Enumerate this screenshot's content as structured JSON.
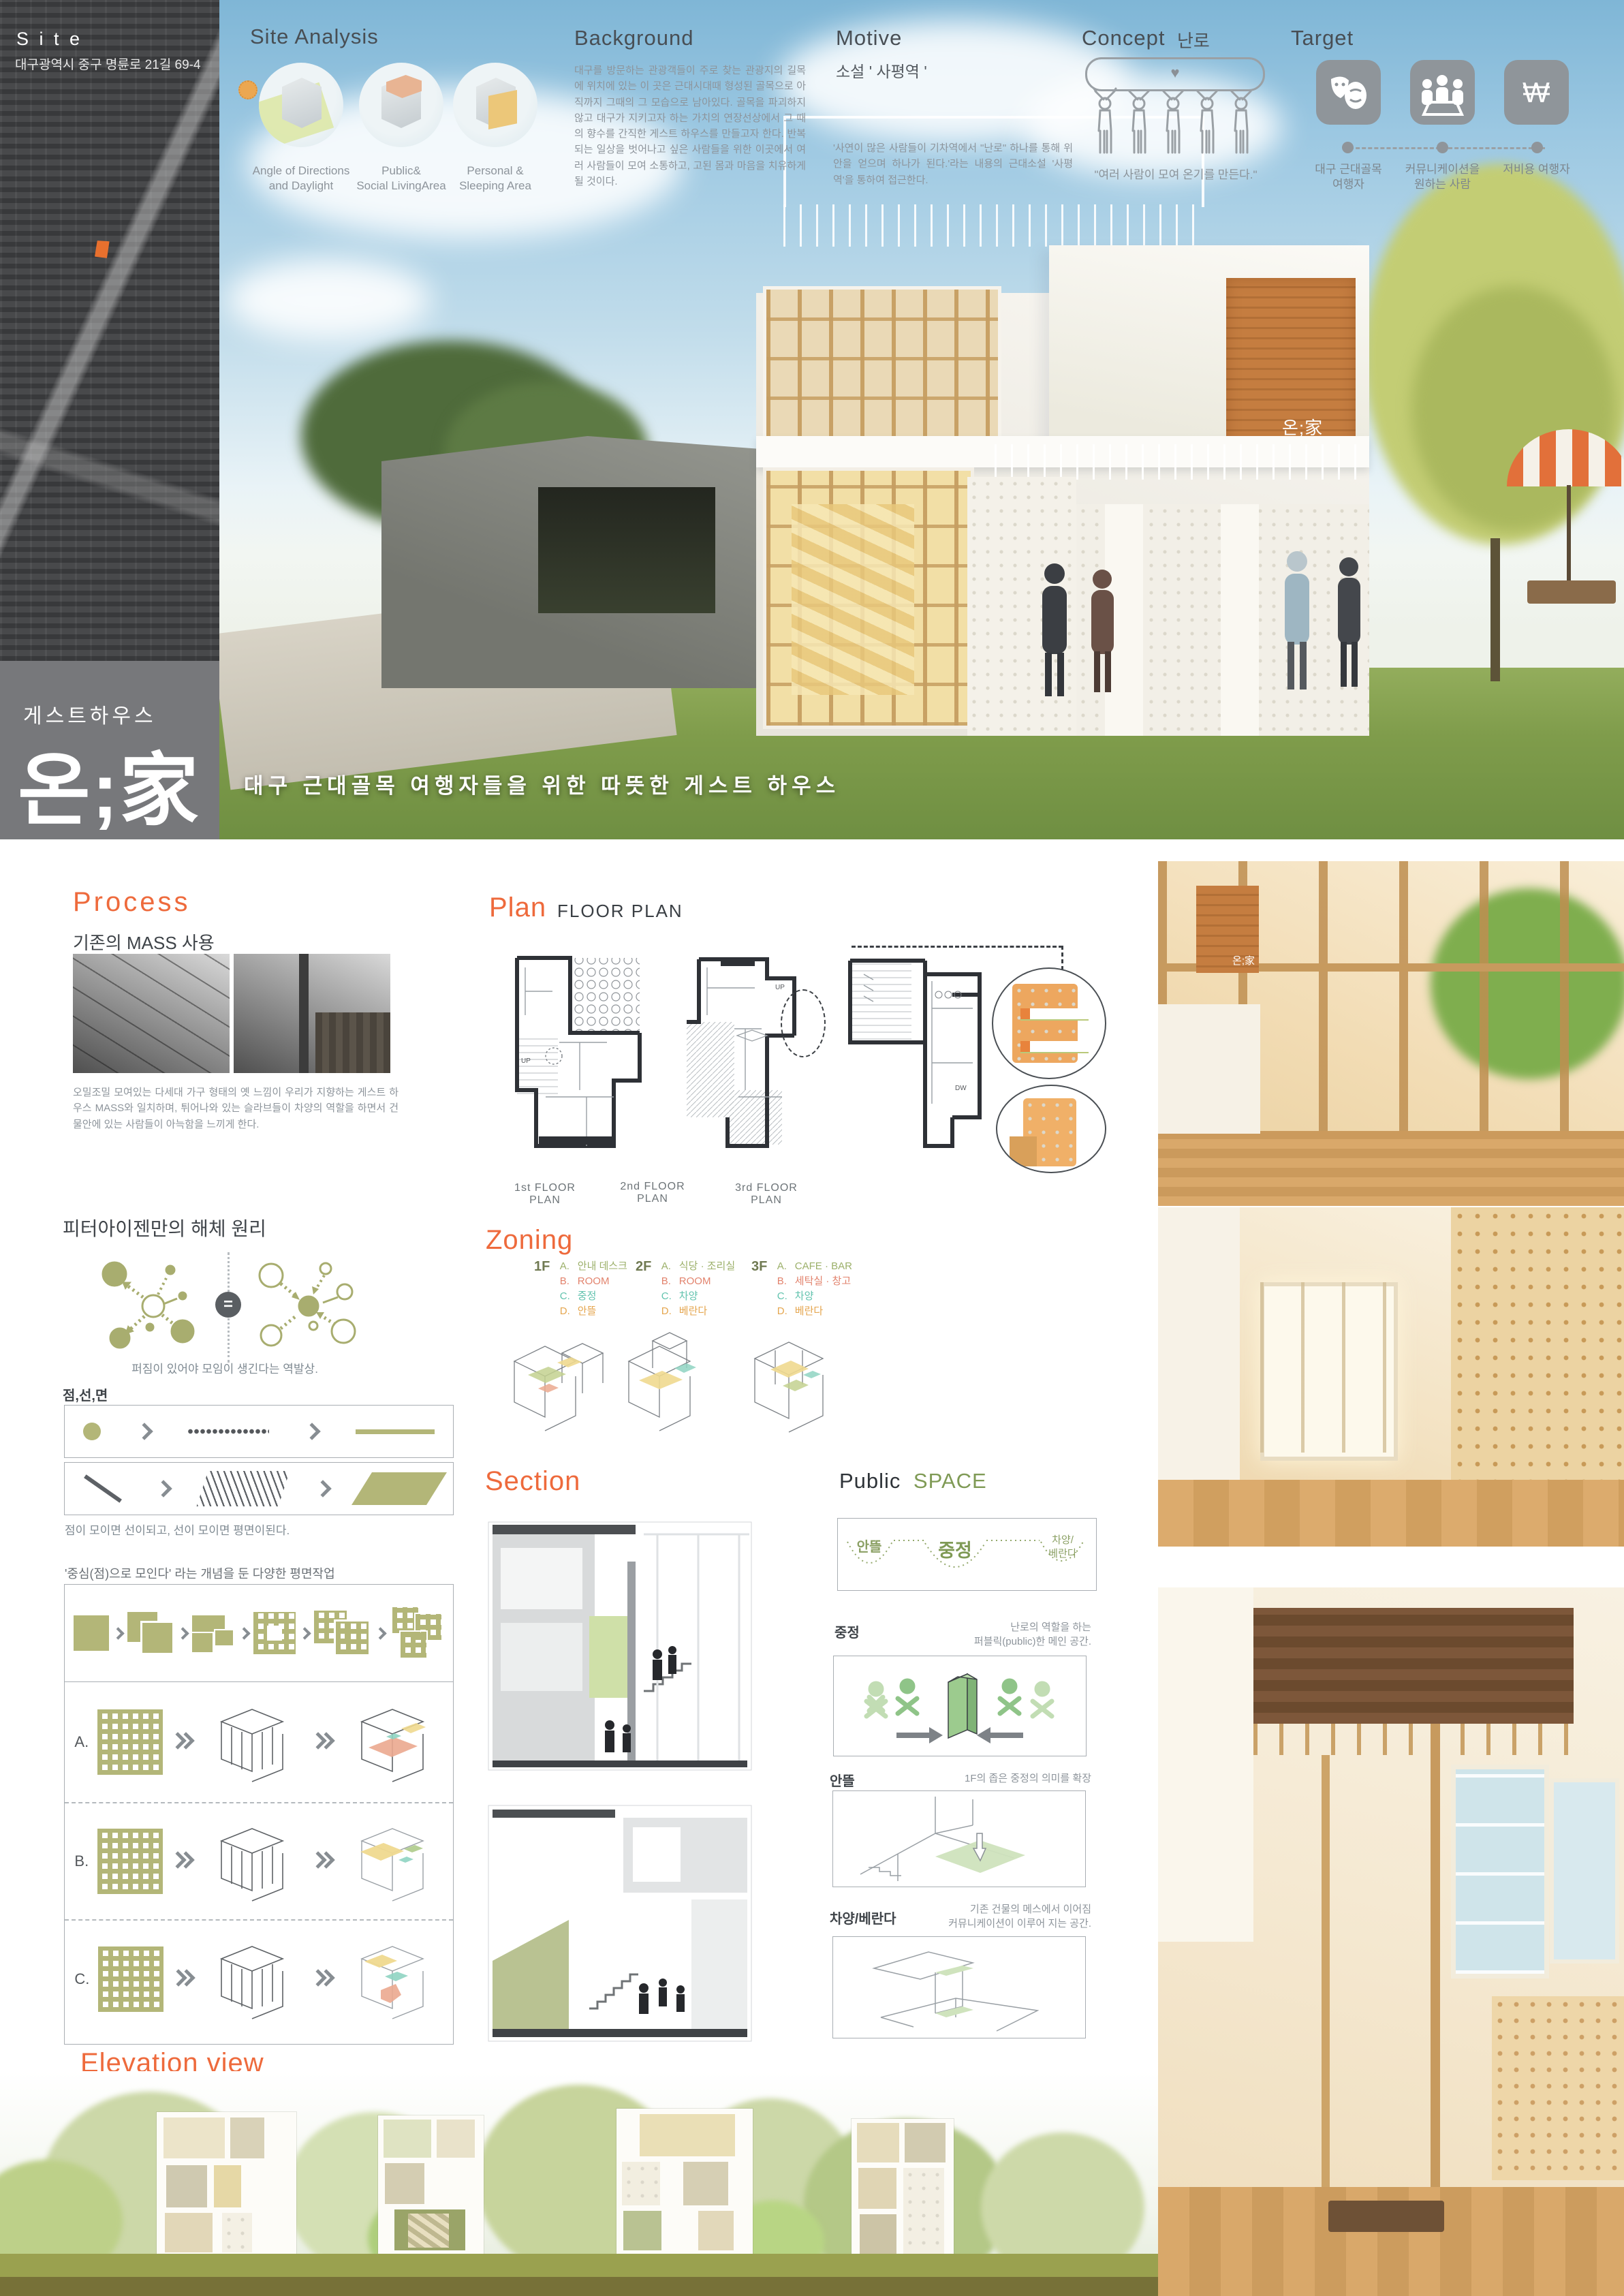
{
  "colors": {
    "accent_orange": "#ee6a3c",
    "olive": "#b3b678",
    "sky_blue": "#9cc8e2",
    "sidebar_gray": "#77787b",
    "zone_a_green": "#9cb06a",
    "zone_b_salmon": "#e2836d",
    "zone_c_teal": "#62c3ae",
    "zone_d_orange": "#e5a64f"
  },
  "icons": {
    "heart": "♥",
    "won": "W"
  },
  "sidebar": {
    "site_title": "S i t e",
    "site_address": "대구광역시 중구 명륜로 21길 69-4",
    "logo_category": "게스트하우스",
    "logo_name": "온;家"
  },
  "hero": {
    "tagline": "대구 근대골목 여행자들을 위한 따뜻한 게스트 하우스",
    "building_sign": "온;家"
  },
  "site_analysis": {
    "title": "Site Analysis",
    "items": [
      {
        "label_line1": "Angle of Directions",
        "label_line2": "and Daylight"
      },
      {
        "label_line1": "Public&",
        "label_line2": "Social LivingArea"
      },
      {
        "label_line1": "Personal &",
        "label_line2": "Sleeping Area"
      }
    ]
  },
  "background": {
    "title": "Background",
    "body": "대구를 방문하는 관광객들이 주로 찾는 관광지의 길목에 위치에 있는 이 곳은 근대시대때 형성된 골목으로 아직까지 그때의 그 모습으로 남아있다. 골목을 파괴하지 않고 대구가 지키고자 하는 가치의 연장선상에서 그 때의 향수를 간직한 게스트 하우스를 만들고자 한다. 반복되는 일상을 벗어나고 싶은 사람들을 위한 이곳에서 여러 사람들이 모여 소통하고, 고된 몸과 마음을 치유하게 될 것이다."
  },
  "motive": {
    "title": "Motive",
    "subtitle": "소설 ' 사평역 '",
    "body": "'사연이 많은 사람들이 기차역에서 \"난로\" 하나를 통해 위안을 얻으며 하나가 된다.'라는 내용의 근대소설 '사평역'을 통하여 접근한다."
  },
  "concept": {
    "title": "Concept",
    "keyword": "난로",
    "caption": "\"여러 사람이 모여 온기를 만든다.\""
  },
  "target": {
    "title": "Target",
    "items": [
      {
        "icon": "theater-masks-icon",
        "label_line1": "대구 근대골목",
        "label_line2": "여행자"
      },
      {
        "icon": "meeting-people-icon",
        "label_line1": "커뮤니케이션을",
        "label_line2": "원하는 사람"
      },
      {
        "icon": "won-currency-icon",
        "label_line1": "저비용 여행자",
        "label_line2": ""
      }
    ]
  },
  "process": {
    "title": "Process",
    "subtitle": "기존의 MASS 사용",
    "body": "오밀조밀 모여있는 다세대 가구 형태의 옛 느낌이 우리가 지향하는 게스트 하우스 MASS와 일치하며, 튀어나와 있는 슬라브들이 차양의 역할을 하면서 건물안에 있는 사람들이 아늑함을 느끼게 한다."
  },
  "eisenman": {
    "title": "피터아이젠만의 해체 원리",
    "equals_sign": "=",
    "caption": "퍼짐이 있어야 모임이 생긴다는 역발상."
  },
  "point_line_plane": {
    "title": "점,선,면",
    "caption": "점이 모이면 선이되고, 선이 모이면 평면이된다.",
    "concept_caption": "'중심(점)으로 모인다' 라는 개념을 둔 다양한 평면작업",
    "row_labels": [
      "A.",
      "B.",
      "C."
    ]
  },
  "plan": {
    "title": "Plan",
    "subtitle": "FLOOR PLAN",
    "floor_labels": [
      "1st FLOOR PLAN",
      "2nd FLOOR PLAN",
      "3rd FLOOR PLAN"
    ],
    "annotations": [
      "UP",
      "DW"
    ]
  },
  "zoning": {
    "title": "Zoning",
    "groups": [
      {
        "floor": "1F",
        "items": [
          {
            "key": "A.",
            "label": "안내 데스크"
          },
          {
            "key": "B.",
            "label": "ROOM"
          },
          {
            "key": "C.",
            "label": "중정"
          },
          {
            "key": "D.",
            "label": "안뜰"
          }
        ]
      },
      {
        "floor": "2F",
        "items": [
          {
            "key": "A.",
            "label": "식당 · 조리실"
          },
          {
            "key": "B.",
            "label": "ROOM"
          },
          {
            "key": "C.",
            "label": "차양"
          },
          {
            "key": "D.",
            "label": "베란다"
          }
        ]
      },
      {
        "floor": "3F",
        "items": [
          {
            "key": "A.",
            "label": "CAFE · BAR"
          },
          {
            "key": "B.",
            "label": "세탁실 · 창고"
          },
          {
            "key": "C.",
            "label": "차양"
          },
          {
            "key": "D.",
            "label": "베란다"
          }
        ]
      }
    ]
  },
  "section": {
    "title": "Section"
  },
  "public_space": {
    "title_main": "Public",
    "title_accent": "SPACE",
    "diagram_labels": [
      "안뜰",
      "중정",
      "차양/",
      "베란다"
    ],
    "blocks": [
      {
        "label": "중정",
        "desc_line1": "난로의 역할을 하는",
        "desc_line2": "퍼블릭(public)한 메인 공간."
      },
      {
        "label": "안뜰",
        "desc_line1": "1F의 좁은 중정의 의미를 확장",
        "desc_line2": ""
      },
      {
        "label": "차양/베란다",
        "desc_line1": "기존 건물의 메스에서 이어짐",
        "desc_line2": "커뮤니케이션이 이루어 지는 공간."
      }
    ]
  },
  "elevation": {
    "title": "Elevation view"
  }
}
